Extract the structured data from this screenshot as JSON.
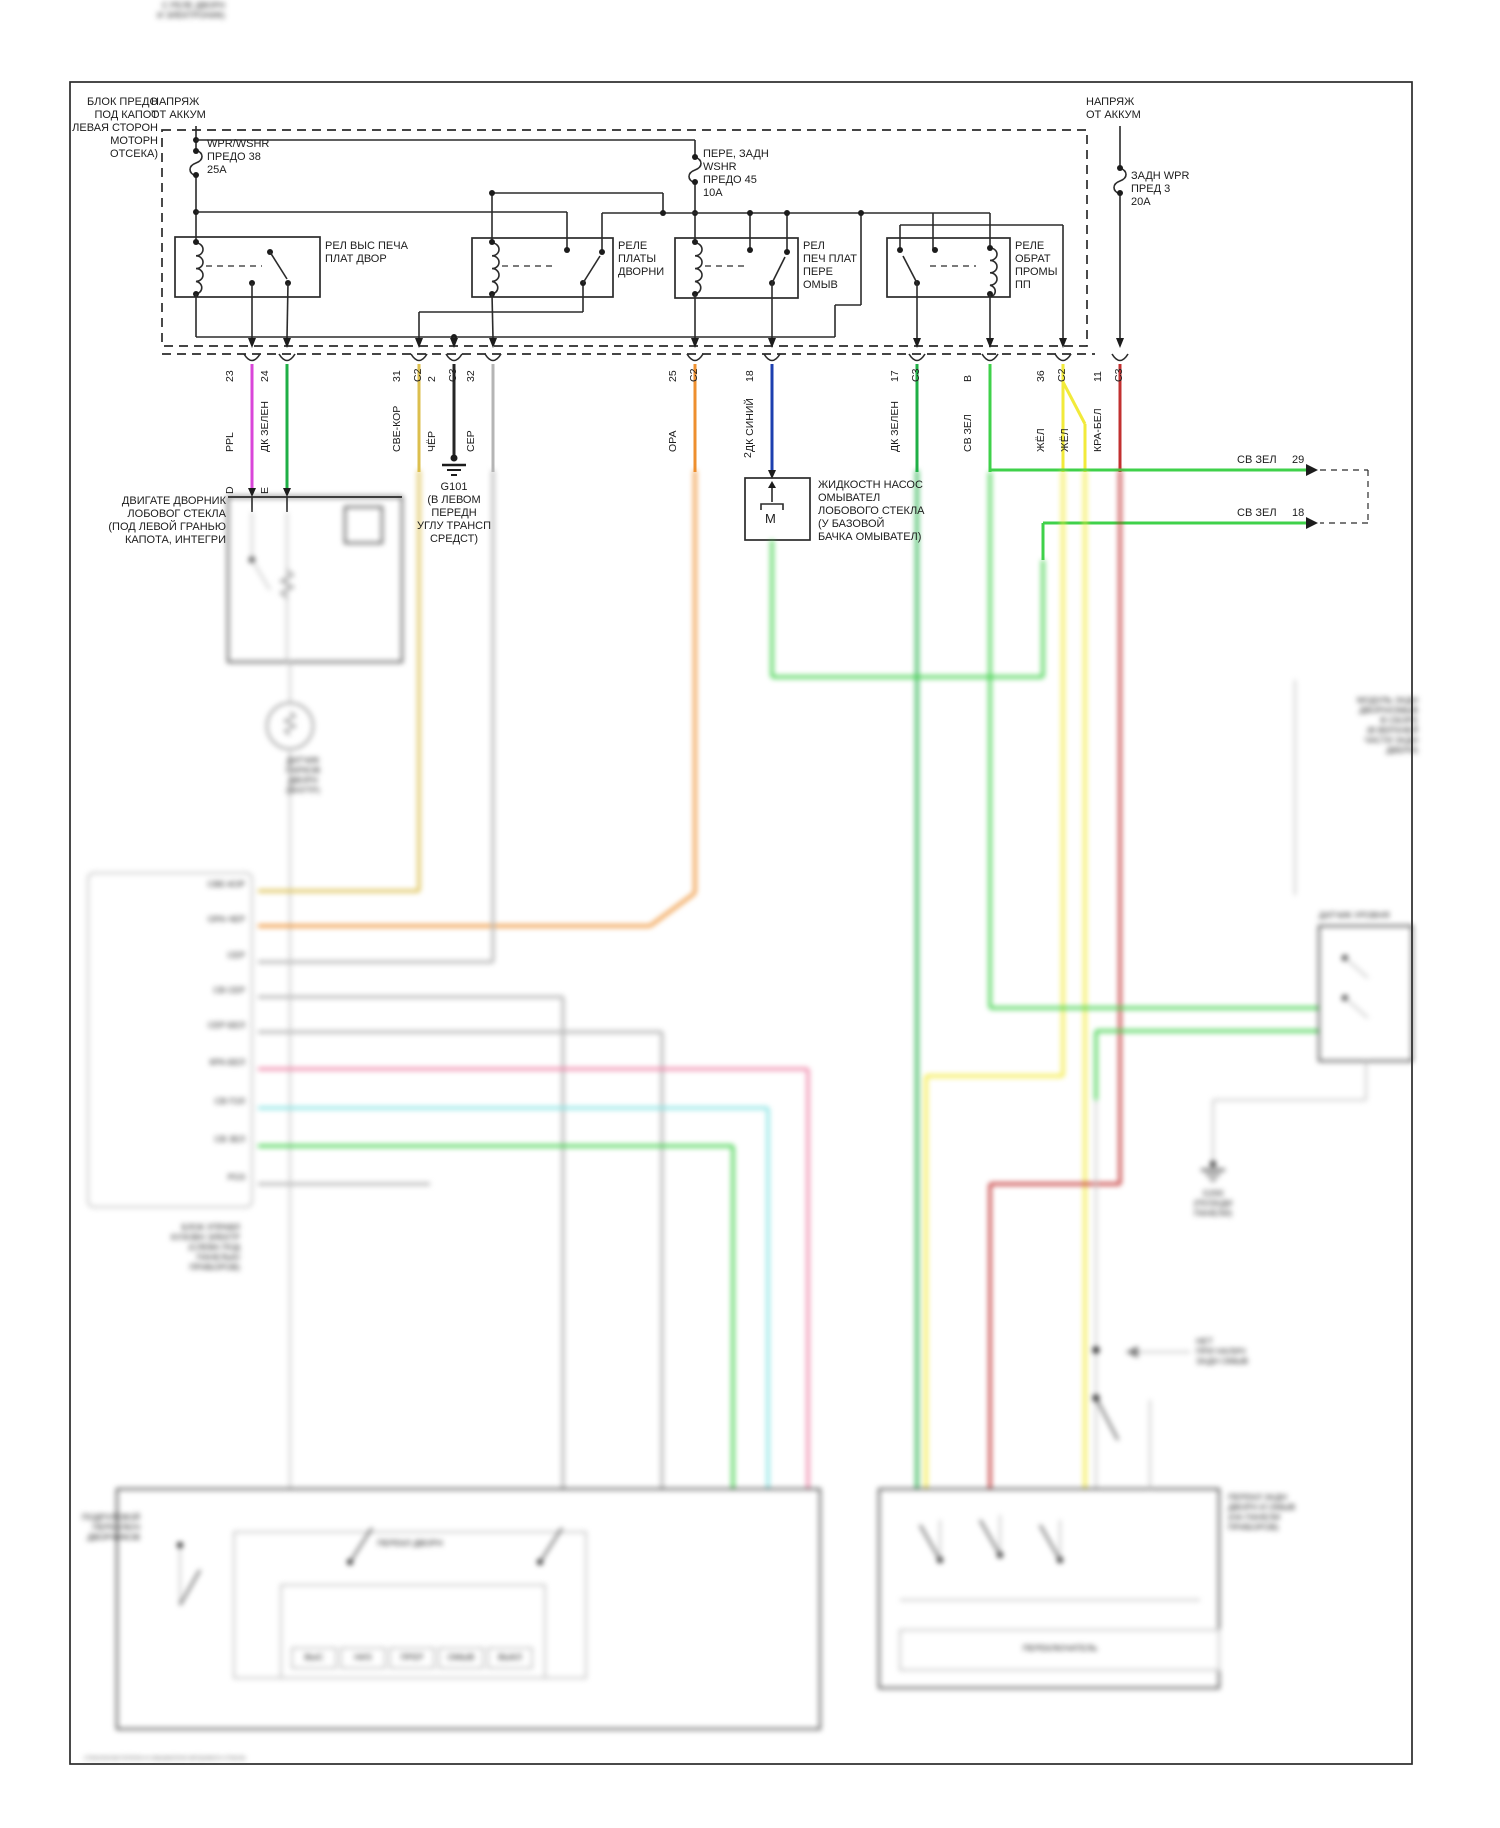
{
  "title": "Схема стеклоочистителей и омывателей",
  "colors": {
    "ppl": "#d946d9",
    "dk_green": "#1faf46",
    "lt_brown": "#dcbf4e",
    "black_wire": "#262626",
    "gray": "#b5b5b5",
    "orange": "#ee8f2e",
    "dk_blue": "#1d3faf",
    "lt_green": "#3fd14a",
    "yellow": "#f2ea3a",
    "red_white": "#c23030",
    "pink": "#ef86a8",
    "cyan": "#86e3e3"
  },
  "power": {
    "left": "НАПРЯЖ\nОТ АККУМ",
    "right": "НАПРЯЖ\nОТ АККУМ"
  },
  "fuse_block": {
    "label": "БЛОК ПРЕДО\nПОД КАПОТ\nЛЕВАЯ СТОРОН\nМОТОРН\nОТСЕКА)",
    "fuse1": "WPR/WSHR\nПРЕДО 38\n25А",
    "fuse2": "ПЕРЕ, ЗАДН\nWSHR\nПРЕДО 45\n10А",
    "fuse3": "ЗАДН WPR\nПРЕД 3\n20А"
  },
  "relays": {
    "r1": "РЕЛ ВЫС ПЕЧА\nПЛАТ ДВОР",
    "r2": "РЕЛЕ\nПЛАТЫ\nДВОРНИ",
    "r3": "РЕЛ\nПЕЧ ПЛАТ\nПЕРЕ\nОМЫВ",
    "r4": "РЕЛЕ\nОБРАТ\nПРОМЫ\nПП"
  },
  "pins": [
    {
      "num": "23",
      "conn": "",
      "wire": "PPL",
      "color": "#d946d9",
      "x": 252
    },
    {
      "num": "24",
      "conn": "",
      "wire": "ДК ЗЕЛЕН",
      "color": "#1faf46",
      "x": 287
    },
    {
      "num": "31",
      "conn": "C2",
      "wire": "СВЕ-КОР",
      "color": "#dcbf4e",
      "x": 419
    },
    {
      "num": "2",
      "conn": "C3",
      "wire": "ЧЁР",
      "color": "#262626",
      "x": 454
    },
    {
      "num": "32",
      "conn": "",
      "wire": "СЕР",
      "color": "#b5b5b5",
      "x": 493
    },
    {
      "num": "25",
      "conn": "C2",
      "wire": "ОРА",
      "color": "#ee8f2e",
      "x": 695
    },
    {
      "num": "18",
      "conn": "",
      "wire": "ДК СИНИЙ",
      "color": "#1d3faf",
      "x": 772
    },
    {
      "num": "17",
      "conn": "C3",
      "wire": "ДК ЗЕЛЕН",
      "color": "#1faf46",
      "x": 917
    },
    {
      "num": "В",
      "conn": "",
      "wire": "СВ ЗЕЛ",
      "color": "#3fd14a",
      "x": 990
    },
    {
      "num": "36",
      "conn": "C2",
      "wire": "ЖЁЛ",
      "color": "#f2ea3a",
      "x": 1063
    },
    {
      "num": "11",
      "conn": "C3",
      "wire": "КРА-БЕЛ",
      "color": "#c23030",
      "x": 1120
    }
  ],
  "second_yellow": "ЖЁЛ",
  "components": {
    "motor": {
      "label": "ДВИГАТЕ ДВОРНИК\nЛОБОВОГ СТЕКЛА\n(ПОД ЛЕВОЙ ГРАНЬЮ\nКАПОТА, ИНТЕГРИ",
      "pin_d": "D",
      "pin_e": "Е"
    },
    "ground": {
      "label": "G101\n(В ЛЕВОМ\nПЕРЕДН\nУГЛУ ТРАНСП\nСРЕДСТ)"
    },
    "pump": {
      "label": "ЖИДКОСТН НАСОС\nОМЫВАТЕЛ\nЛОБОВОГО СТЕКЛА\n(У БАЗОВОЙ\nБАЧКА ОМЫВАТЕЛ)",
      "pin": "2",
      "motor_letter": "M"
    }
  },
  "offpage": [
    {
      "label": "СВ ЗЕЛ",
      "num": "29"
    },
    {
      "label": "СВ ЗЕЛ",
      "num": "18"
    }
  ],
  "blurred": {
    "motor_extra": "С РЕЛЕ ДВОРН\nИ ЭЛЕКТРОНИК)",
    "park_sensor": "ДАТЧИК\nПАРКОВ\nДВОРН\n(ВНУТР)",
    "rows": [
      {
        "label": "СВЕ-КОР",
        "y": 891
      },
      {
        "label": "ОРА-ЧЕР",
        "y": 926
      },
      {
        "label": "СЕР",
        "y": 962
      },
      {
        "label": "СВ СЕР",
        "y": 997
      },
      {
        "label": "СЕР-БЕЛ",
        "y": 1032
      },
      {
        "label": "КРА-БЕЛ",
        "y": 1069
      },
      {
        "label": "СВ ГОЛ",
        "y": 1108
      },
      {
        "label": "СВ ЗЕЛ",
        "y": 1146
      },
      {
        "label": "РОЗ",
        "y": 1184
      }
    ],
    "bcm_label": "БЛОК УПРАВЛ\nКУЗОВН ЭЛЕКТР\n(СЛЕВА ПОД\nПАНЕЛЬЮ\nПРИБОРОВ)",
    "stalk_label": "ПОДРУЛЕВОЙ\nПЕРЕКЛЮЧ\nДВОРНИКОВ",
    "mode_boxes": [
      "ВЫС",
      "НИЗ",
      "ПРЕР",
      "ОМЫВ",
      "ВЫКЛ"
    ],
    "inner_switch_label": "ПЕРЕКЛ ДВОРН",
    "rear_switch_label": "ПЕРЕКЛ ЗАДН\nДВОРН И ОМЫВ\n(НА ПАНЕЛИ\nПРИБОРОВ)",
    "rear_inner_label": "ПЕРЕКЛЮЧАТЕЛЬ",
    "note_no_washer": "НЕТ\nПРИ НАЛИЧ\nЗАДН ОМЫВ",
    "rear_module": "МОДУЛЬ ЗАДН\nДВОРН/ОМЫВ\nВ СБОРЕ\n(В ВЕРХНЕЙ\nЧАСТИ ЗАДН\nДВЕРИ)",
    "level_sensor": "ДАТЧИК УРОВНЯ",
    "ground2": "G200\n(ПОЗАДИ\nПАНЕЛИ)",
    "footer": "стеклоочистители-и-омыватели-ветрового-стекла"
  }
}
